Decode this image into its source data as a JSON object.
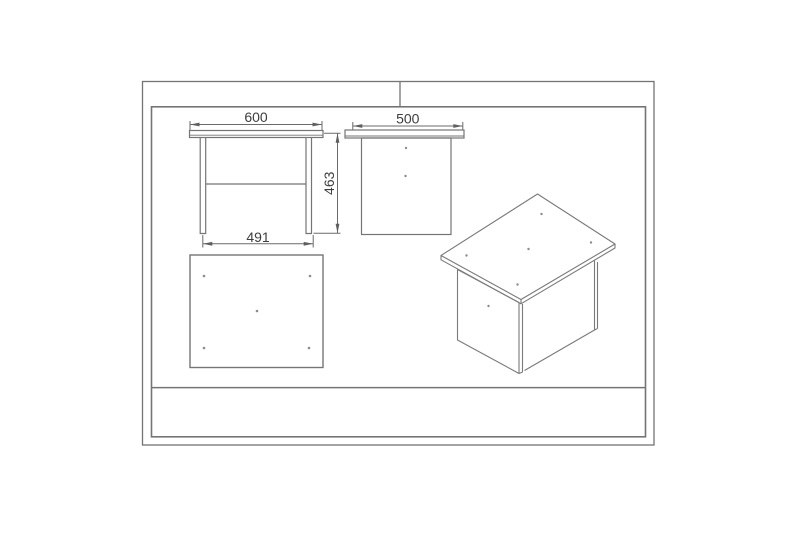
{
  "drawing": {
    "colors": {
      "background": "#ffffff",
      "frame_line": "#747474",
      "drawing_line": "#757575",
      "dimension_line": "#6a6a6a",
      "text": "#3d3d3d",
      "dot": "#8c8c8c"
    },
    "views": {
      "front": {
        "width_label": "600",
        "height_label": "463",
        "inner_width_label": "491"
      },
      "side": {
        "width_label": "500"
      },
      "plan": {
        "dot_count": 5
      },
      "isometric": {
        "top_dot_count": 5,
        "panel_dot_count": 1
      }
    }
  }
}
